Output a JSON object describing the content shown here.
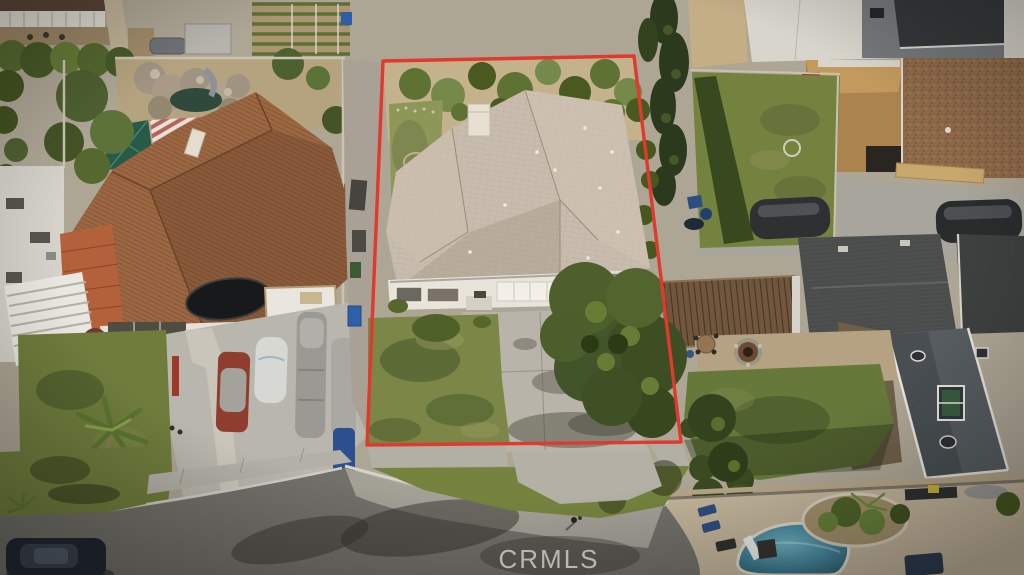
{
  "meta": {
    "type": "aerial-drone-photo",
    "description": "Overhead drone photo of a suburban cul-de-sac; the listed property's lot is outlined in red."
  },
  "watermark": {
    "text": "CRMLS",
    "color": "#dcdcd8"
  },
  "boundary": {
    "color": "#e0392e",
    "stroke_width": 3.4,
    "points": "383,61 634,56 681,442 367,445"
  },
  "scene": {
    "subject_property": [
      "tan shingle hip roof",
      "white chimney",
      "white facade with garage door and windows",
      "concrete driveway",
      "front lawn",
      "large front-yard tree",
      "rear yard with shrub row, dirt and small lawn"
    ],
    "left_neighbor": [
      "spanish tile roof house",
      "red flowering shrubs",
      "trampoline",
      "white garage wing",
      "backyard rock pond with slide",
      "green canopy",
      "red-striped awning",
      "front lawn with palm tree",
      "driveway with covered vehicles and blue boat",
      "white slat patio cover",
      "garden beds",
      "shed"
    ],
    "right_neighbor": [
      "tall cypress hedge",
      "rear lawn with hedge row",
      "wood shed with red shelving",
      "brown gravel roof",
      "two covered cars",
      "wood pergola",
      "dark shingle roof house with white trim gable and green window",
      "fire pit",
      "patio table",
      "front lawn and street trees"
    ],
    "bottom_right_yard": [
      "swimming pool with diving board",
      "planter island with palm",
      "tan pool deck",
      "blue loungers",
      "navy umbrella"
    ],
    "street": [
      "cul-de-sac asphalt with tire marks",
      "concrete curb and gutter",
      "sidewalk",
      "parkway lawns",
      "parked dark car",
      "pedestrian"
    ]
  },
  "palette": {
    "asphalt": "#71706a",
    "concrete": "#b3b0a7",
    "subject_roof": "#c8bcae",
    "tile_roof": "#9a6742",
    "lawn": "#75833f",
    "tree_foliage": "#44572a",
    "pool_water": "#45869c",
    "dirt": "#c3ae86",
    "dark_roof": "#4a4d4b"
  }
}
